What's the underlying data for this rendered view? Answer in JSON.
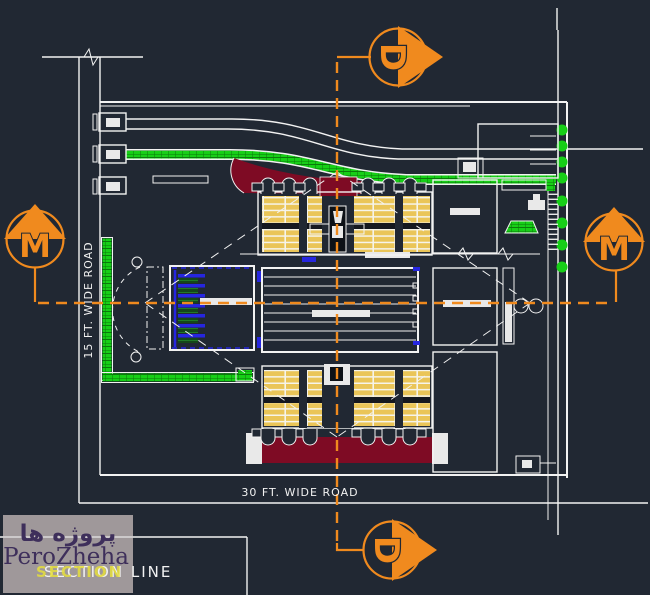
{
  "page": {
    "type": "cad-site-plan-drawing",
    "background": "#212833"
  },
  "labels": {
    "road_bottom": "30 FT. WIDE ROAD",
    "road_left": "15 FT. WIDE ROAD",
    "section_line": "SECTION LINE"
  },
  "markers": {
    "section_top": "D",
    "section_bottom": "D",
    "section_left": "M",
    "section_right": "M"
  },
  "watermark": {
    "text_fa": "پروژه ها",
    "text_en": "PeroZheha",
    "ghost_text": "SECTION"
  },
  "colors": {
    "background": "#212833",
    "line_white": "#F2F2F2",
    "section_orange": "#F08A1E",
    "seating_yellow": "#EAC558",
    "carpet_maroon": "#7E0B24",
    "landscape_green": "#17CF17",
    "detail_blue": "#2626E0",
    "watermark_bg": "#A9A1A2",
    "watermark_purple": "#3E2F5B",
    "watermark_yellow": "#E6DF3C"
  }
}
